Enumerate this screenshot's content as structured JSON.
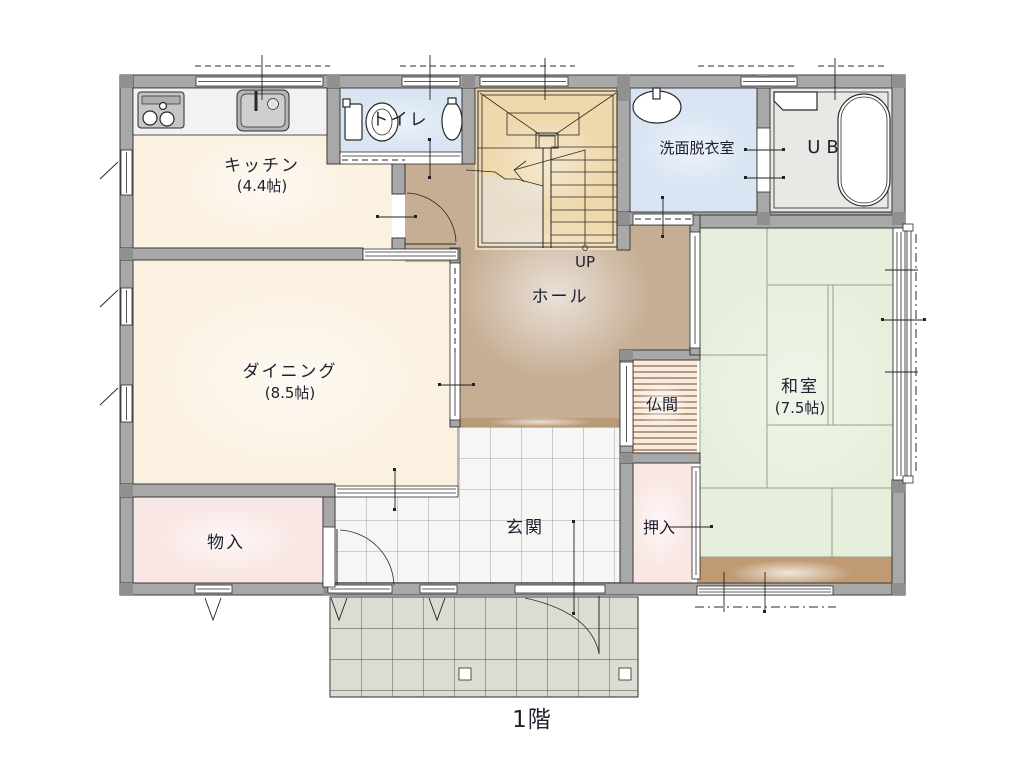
{
  "meta": {
    "floor_label": "1階",
    "up_label": "UP"
  },
  "rooms": {
    "kitchen": {
      "name": "キッチン",
      "size": "(4.4帖)"
    },
    "dining": {
      "name": "ダイニング",
      "size": "(8.5帖)"
    },
    "toilet": {
      "name": "トイレ"
    },
    "washroom": {
      "name": "洗面脱衣室"
    },
    "bath": {
      "name": "UB"
    },
    "hall": {
      "name": "ホール"
    },
    "washitsu": {
      "name": "和室",
      "size": "(7.5帖)"
    },
    "butsuma": {
      "name": "仏間"
    },
    "oshiire": {
      "name": "押入"
    },
    "genkan": {
      "name": "玄関"
    },
    "storage": {
      "name": "物入"
    }
  },
  "colors": {
    "wall": "#a8a8a8",
    "wall_edge": "#3a3a3a",
    "kitchen": "#fbf1e1",
    "dining": "#fbf1e1",
    "hall": "#c6ae94",
    "hall_light": "#e9ddcb",
    "stairs": "#efd8ac",
    "water": "#d9e5f3",
    "bath_floor": "#e8e8e5",
    "tatami": "#e6efdc",
    "tatami_line": "#93a488",
    "butsuma": "#f9ebdd",
    "closet": "#f9e7e5",
    "tile": "#f6f6f4",
    "porch": "#dcdcd2",
    "wood": "#c09a72",
    "threshold": "#b99a78",
    "counter": "#f2f2f2",
    "label": "#1f1f30"
  }
}
